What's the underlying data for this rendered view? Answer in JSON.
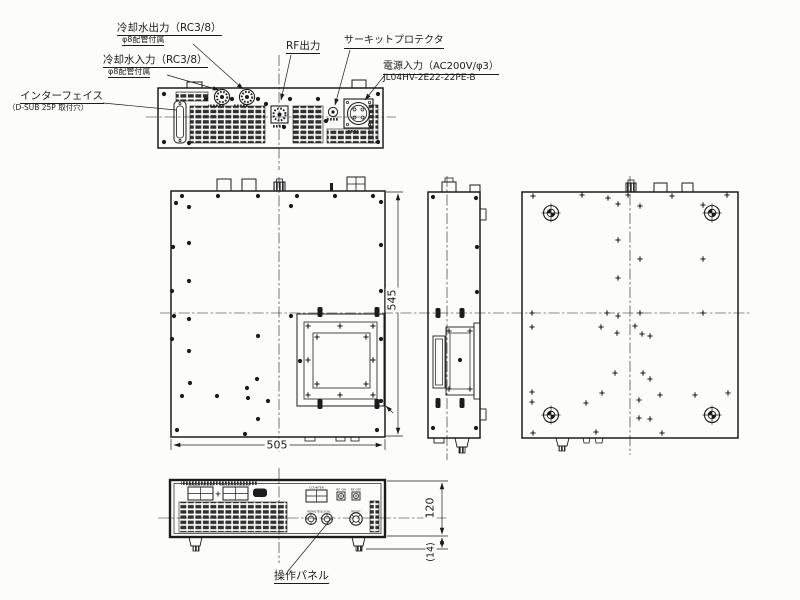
{
  "callouts": {
    "cooling_water_out": {
      "line1": "冷却水出力（RC3/8）",
      "line2": "φ8配管付属"
    },
    "cooling_water_in": {
      "line1": "冷却水入力（RC3/8）",
      "line2": "φ8配管付属"
    },
    "rf_output": {
      "line1": "RF出力"
    },
    "circuit_protector": {
      "line1": "サーキットプロテクタ"
    },
    "power_input": {
      "line1": "電源入力（AC200V/φ3）",
      "line2": "JL04HV-2E22-22PE-B"
    },
    "interface": {
      "line1": "インターフェイス",
      "line2": "（D-SUB 25P 取付穴）"
    },
    "operation_panel": {
      "line1": "操作パネル"
    }
  },
  "dimensions": {
    "depth": "545",
    "width": "505",
    "front_height": "120",
    "foot_height": "(14)"
  },
  "front_panel": {
    "meter1_label": "FORWARD POWER",
    "meter2_label": "REFLECTED POWER",
    "plus_sign": "+",
    "counter_label": "COUNTER",
    "rf_on_label": "RF ON",
    "rf_off_label": "RF OFF",
    "aux_label": "REMOTE/LOCAL",
    "reset_label": "RESET"
  },
  "colors": {
    "line": "#1c1c1c",
    "background": "#fcfcfa"
  }
}
